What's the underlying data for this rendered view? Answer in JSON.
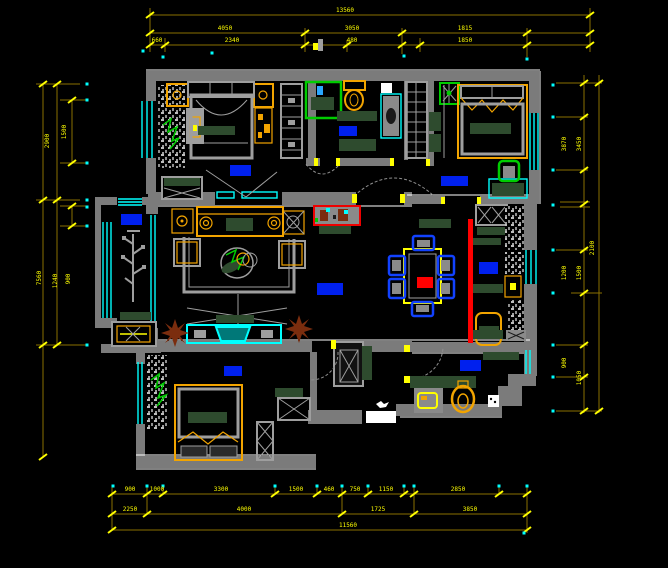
{
  "title": "apartment-floor-plan-cad",
  "colors": {
    "background": "#000000",
    "wall": "#7b7b7b",
    "furniture_gray": "#9e9e9e",
    "dimension_line": "#8a7000",
    "dimension_text": "#ffff00",
    "window": "#00ffff",
    "room_label": "#0020ee",
    "chair_blue": "#1242ff",
    "accent_red": "#ff0000",
    "plant_brown": "#7b2d0e",
    "plant_green": "#00cc00",
    "counter_green": "#2e4b2e",
    "wood_orange": "#f2a400",
    "tv_teal": "#007878",
    "white": "#ffffff"
  },
  "rooms": [
    {
      "name": "master-bedroom"
    },
    {
      "name": "bathroom"
    },
    {
      "name": "bedroom-right"
    },
    {
      "name": "living-room"
    },
    {
      "name": "balcony"
    },
    {
      "name": "dining-room"
    },
    {
      "name": "pantry-column"
    },
    {
      "name": "bedroom-bottom"
    },
    {
      "name": "kitchen"
    },
    {
      "name": "foyer"
    }
  ],
  "dims": {
    "top": {
      "row1": [
        "13560"
      ],
      "row2": [
        "4050",
        "3050",
        "1815"
      ],
      "row3": [
        "660",
        "2340",
        "480",
        "1850"
      ]
    },
    "left": [
      "2900",
      "1500",
      "7560",
      "1240",
      "900"
    ],
    "right": [
      "3870",
      "3450",
      "2100",
      "1200",
      "1500",
      "900",
      "1050"
    ],
    "bottom": {
      "row1": [
        "900",
        "1000",
        "3300",
        "1500",
        "460",
        "750",
        "1150",
        "2850"
      ],
      "row2": [
        "2250",
        "4000",
        "1725",
        "3850"
      ],
      "row3": [
        "11560"
      ]
    }
  }
}
